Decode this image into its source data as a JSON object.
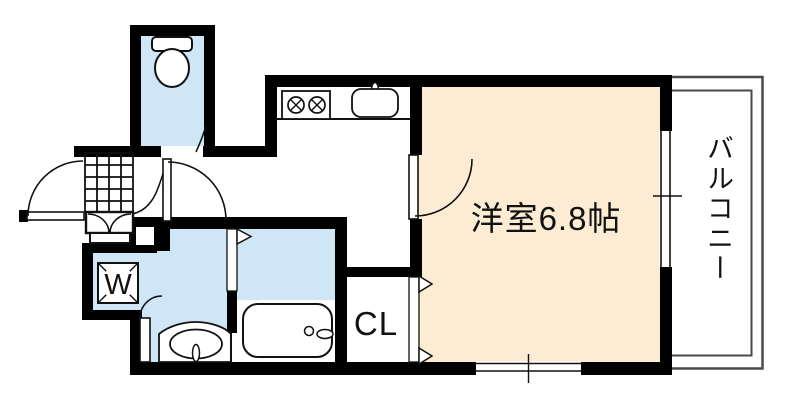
{
  "floorplan": {
    "labels": {
      "main_room": "洋室6.8帖",
      "balcony": "バルコニー",
      "closet": "CL",
      "washing_machine": "W"
    },
    "colors": {
      "wall": "#000000",
      "wet_area_floor": "#cfe6f7",
      "main_room_floor": "#fcecd3",
      "balcony_outline": "#4a4a4a",
      "background": "#ffffff"
    },
    "fixtures": [
      "toilet-icon",
      "bathtub-icon",
      "washbasin-icon",
      "washing-machine-icon",
      "stove-icon",
      "kitchen-sink-icon"
    ]
  }
}
